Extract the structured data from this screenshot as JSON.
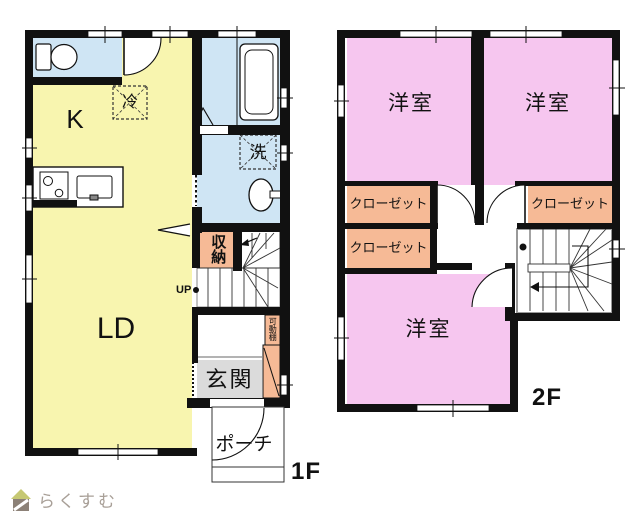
{
  "floor1": {
    "label": "1F",
    "kitchen": "K",
    "living_dining": "LD",
    "entrance": "玄関",
    "porch": "ポーチ",
    "storage": "収納",
    "refrigerator": "冷",
    "washing_machine": "洗",
    "movable_shelf": "可動棚",
    "stairs_direction": "UP"
  },
  "floor2": {
    "label": "2F",
    "room1": "洋室",
    "room2": "洋室",
    "room3": "洋室",
    "closet1": "クローゼット",
    "closet2": "クローゼット",
    "closet3": "クローゼット"
  },
  "branding": {
    "logo": "らくすむ"
  },
  "colors": {
    "room_yellow": "#F8F5AF",
    "wet_area_blue": "#CFE5F4",
    "bedroom_pink": "#F6C6EF",
    "closet_orange": "#F6BA96",
    "entrance_gray": "#DBDBDB",
    "wall_black": "#111111",
    "stair_border_gray": "#999999",
    "logo_taupe": "#A89F97",
    "logo_roof_green": "#C6C873"
  }
}
